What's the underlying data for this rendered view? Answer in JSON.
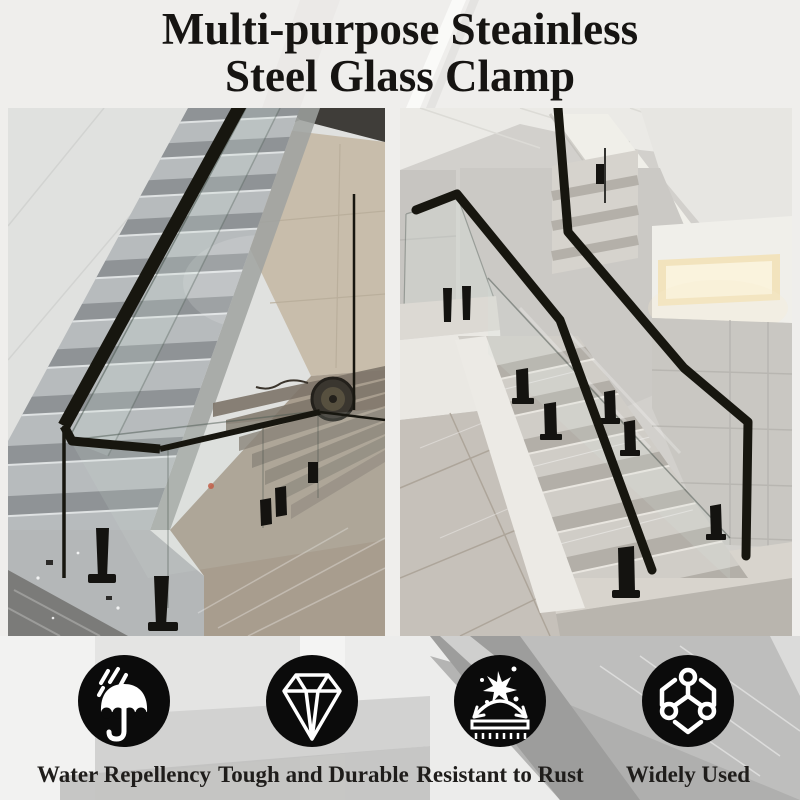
{
  "title": {
    "line1": "Multi-purpose Steainless",
    "line2": "Steel Glass Clamp"
  },
  "features": [
    {
      "icon": "umbrella-rain-icon",
      "label": "Water Repellency"
    },
    {
      "icon": "diamond-icon",
      "label": "Tough and Durable"
    },
    {
      "icon": "splash-arrow-icon",
      "label": "Resistant to Rust"
    },
    {
      "icon": "molecule-icon",
      "label": "Widely Used"
    }
  ],
  "colors": {
    "page_background": "#efeeec",
    "title_text": "#161412",
    "icon_circle": "#0b0b0b",
    "icon_glyph": "#ffffff",
    "label_text": "#1f1d1b",
    "handrail_black": "#17160f",
    "marble_gray": "#b7bbbd",
    "beige_wall": "#c8bdab"
  }
}
